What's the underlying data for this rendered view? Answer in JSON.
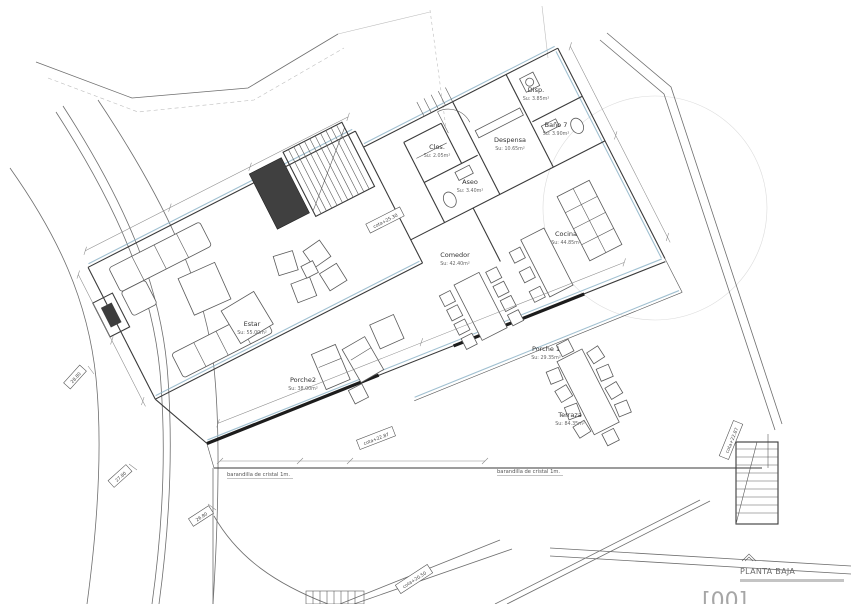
{
  "drawing": {
    "title_tag": "[00]",
    "title": "PLANTA BAJA"
  },
  "rooms": [
    {
      "name": "Estar",
      "area": "Su: 55.00m²"
    },
    {
      "name": "Comedor",
      "area": "Su: 42.40m²"
    },
    {
      "name": "Cocina",
      "area": "Su: 44.85m²"
    },
    {
      "name": "Despensa",
      "area": "Su: 10.65m²"
    },
    {
      "name": "Disp.",
      "area": "Su: 3.85m²"
    },
    {
      "name": "Baño 7",
      "area": "Su: 3.90m²"
    },
    {
      "name": "Aseo",
      "area": "Su: 3.40m²"
    },
    {
      "name": "Clos.",
      "area": "Su: 2.05m²"
    },
    {
      "name": "Porche2",
      "area": "Su: 38.00m²"
    },
    {
      "name": "Porche 1",
      "area": "Su: 29.35m²"
    },
    {
      "name": "Terraza",
      "area": "Su: 84.35m²"
    }
  ],
  "annotations": {
    "railings": [
      "barandilla de cristal 1m.",
      "barandilla de cristal 1m."
    ],
    "cotas": [
      "cota+25.30",
      "cota+22.87",
      "cota+22.87",
      "cota+20.50"
    ],
    "elevations": [
      "28.80",
      "27.80",
      "26.80"
    ]
  },
  "colors": {
    "line": "#3a3a3a",
    "glazing": "#8fb5c9",
    "heavy": "#1c1c1c"
  }
}
